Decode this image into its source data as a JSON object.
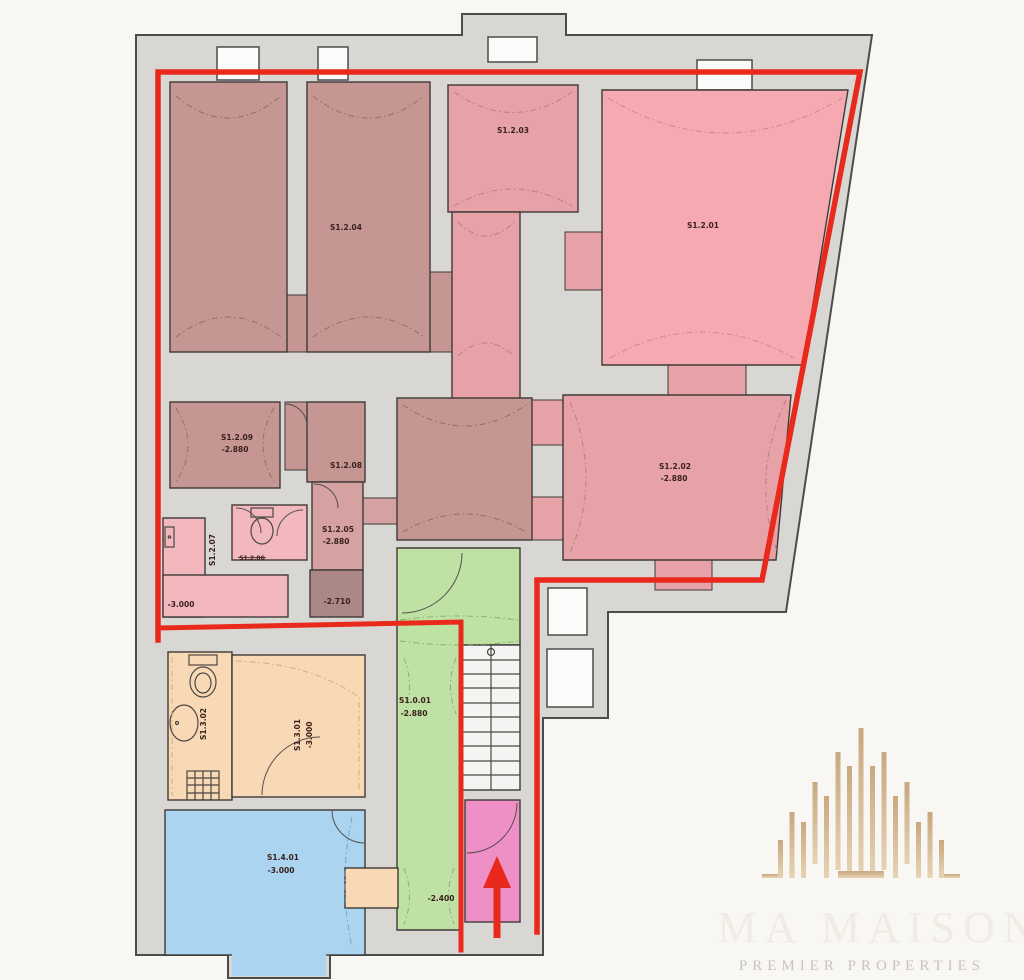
{
  "rooms": {
    "s1204": {
      "label": "S1.2.04"
    },
    "s1203": {
      "label": "S1.2.03"
    },
    "s1201": {
      "label": "S1.2.01"
    },
    "s1202": {
      "label": "S1.2.02",
      "level": "-2.880"
    },
    "s1209": {
      "label": "S1.2.09",
      "level": "-2.880"
    },
    "s1208": {
      "label": "S1.2.08"
    },
    "s1205": {
      "label": "S1.2.05",
      "level": "-2.880"
    },
    "s1205_lower": {
      "level": "-2.710"
    },
    "s1207": {
      "label": "S1.2.07",
      "level": "-3.000"
    },
    "s1206": {
      "label": "S1.2.06"
    },
    "s1001": {
      "label": "S1.0.01",
      "level": "-2.880"
    },
    "s1001_lower": {
      "level": "-2.400"
    },
    "s1302": {
      "label": "S1.3.02"
    },
    "s1301": {
      "label": "S1.3.01",
      "level": "-3.000"
    },
    "s1401": {
      "label": "S1.4.01",
      "level": "-3.000"
    }
  },
  "watermark": {
    "name": "MA MAISON",
    "tagline": "PREMIER PROPERTIES"
  },
  "colors": {
    "boundary_red": "#e8291c",
    "wall_gray": "#d8d7d4",
    "room_mauve": "#c69693",
    "room_rose": "#e6a2a6",
    "room_bright_pink": "#f7a9b2",
    "room_light_pink": "#f2b8bd",
    "room_dusty": "#d6a1a1",
    "room_dark_mauve": "#ab8785",
    "room_green": "#bfe1a3",
    "room_orange": "#f9d9b5",
    "room_blue": "#aad4f0",
    "room_magenta": "#ee90c6",
    "watermark_tan": "#d5b68d"
  }
}
